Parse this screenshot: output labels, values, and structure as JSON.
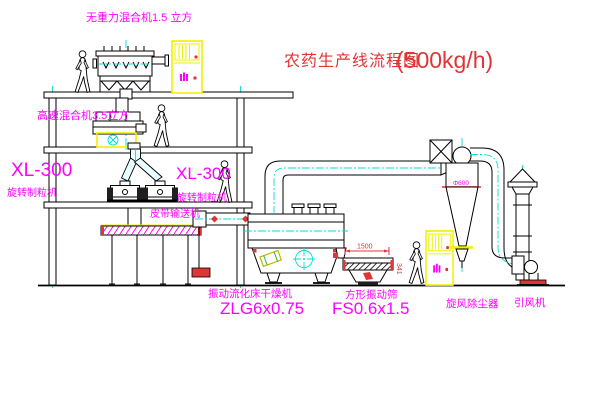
{
  "title": {
    "text": "农药生产线流程图",
    "capacity": "(500kg/h)"
  },
  "colors": {
    "label_magenta": "#ff00ff",
    "title_red": "#e03535",
    "equipment_yellow": "#f0f000",
    "centerline_cyan": "#00dede",
    "line_black": "#000000",
    "background": "#ffffff"
  },
  "equipment_labels": {
    "gravity_mixer": "无重力混合机1.5 立方",
    "high_speed_mixer": "高速混合机3.5立方",
    "granulator_left_model": "XL-300",
    "granulator_left_name": "旋转制粒机",
    "granulator_right_model": "XL-300",
    "granulator_right_name": "旋转制粒机",
    "belt_conveyor": "皮带输送机",
    "dryer_name": "振动流化床干燥机",
    "dryer_model": "ZLG6x0.75",
    "sieve_name": "方形振动筛",
    "sieve_model": "FS0.6x1.5",
    "cyclone_name": "旋风除尘器",
    "fan_name": "引风机"
  },
  "dimension_labels": {
    "cyclone_diameter": "Φ600",
    "sieve_length": "1500",
    "sieve_outlet_height": "341"
  }
}
